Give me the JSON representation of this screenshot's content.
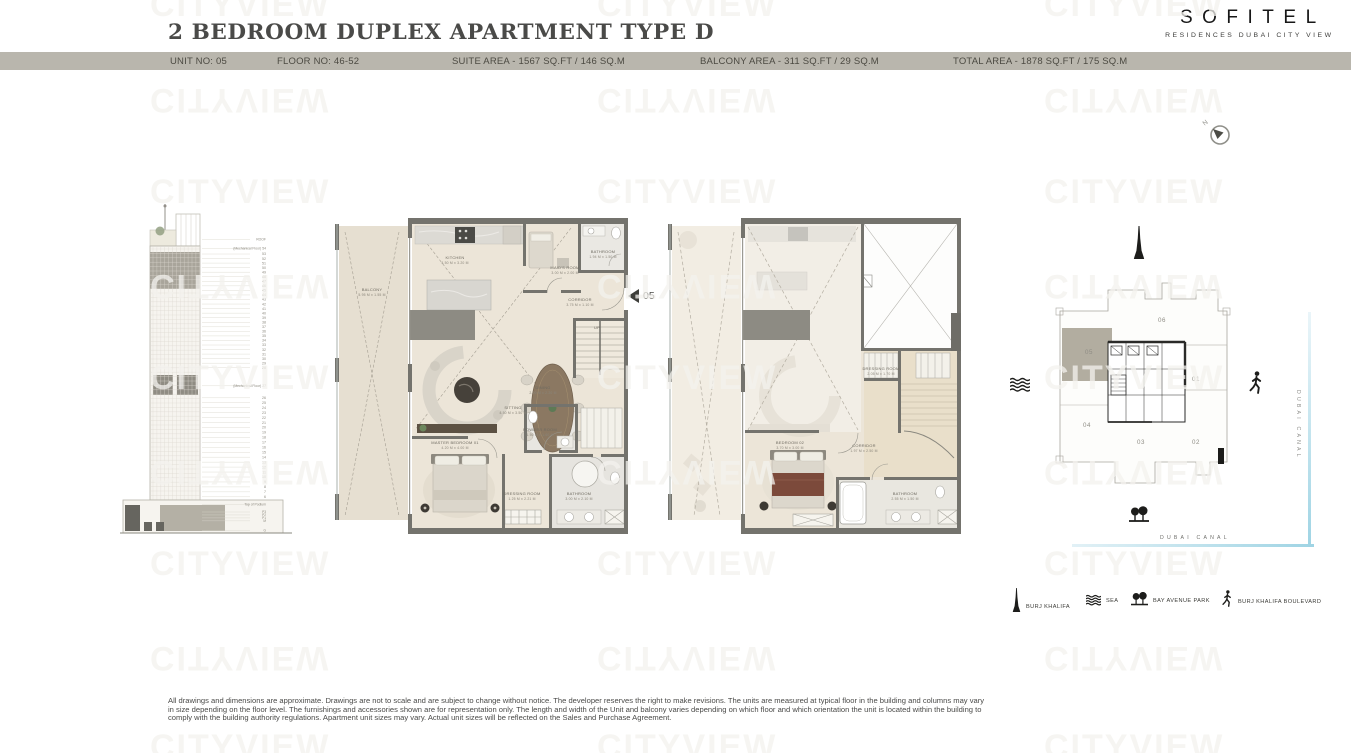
{
  "watermark": "CITYVIEW",
  "header": {
    "title": "2 BEDROOM DUPLEX APARTMENT TYPE D",
    "brand": {
      "name": "SOFITEL",
      "subtitle": "RESIDENCES DUBAI CITY VIEW"
    },
    "info_bar": {
      "unit": "UNIT NO: 05",
      "floor": "FLOOR NO: 46-52",
      "suite_area": "SUITE AREA - 1567 SQ.FT / 146 SQ.M",
      "balcony_area": "BALCONY AREA - 311 SQ.FT / 29 SQ.M",
      "total_area": "TOTAL AREA - 1878 SQ.FT / 175 SQ.M"
    }
  },
  "compass_label": "N",
  "unit_marker": "05",
  "elevation": {
    "top_label": "ROOF",
    "mech_upper": "(Mechanical Floor) 54",
    "upper_floors": [
      "53",
      "52",
      "51",
      "50",
      "49",
      "48",
      "47",
      "46",
      "45",
      "44",
      "43",
      "42",
      "41",
      "40",
      "39",
      "38",
      "37",
      "36",
      "35",
      "34",
      "33",
      "32",
      "31",
      "30",
      "29",
      "28"
    ],
    "mech_lower": "(Mechanical Floor) 27",
    "lower_floors": [
      "26",
      "25",
      "24",
      "23",
      "22",
      "21",
      "20",
      "19",
      "18",
      "17",
      "16",
      "15",
      "14",
      "13",
      "12",
      "11",
      "10",
      "9",
      "8",
      "7",
      "6"
    ],
    "podium_label": "Top of Podium",
    "podium_floors": [
      "P3",
      "P2",
      "P1",
      "M"
    ],
    "ground_label": "G"
  },
  "plans": {
    "lower": {
      "rooms": {
        "balcony": {
          "name": "BALCONY",
          "dims": "5.95 M x 1.55 M"
        },
        "kitchen": {
          "name": "KITCHEN",
          "dims": "4.50 M x 3.20 M"
        },
        "maids": {
          "name": "MAID'S ROOM",
          "dims": "3.00 M x 2.00 M"
        },
        "bath_top": {
          "name": "BATHROOM",
          "dims": "1.94 M x 1.50 M"
        },
        "corridor": {
          "name": "CORRIDOR",
          "dims": "3.75 M x 1.10 M"
        },
        "dining": {
          "name": "DINING",
          "dims": "2.00 M x 2.20 M"
        },
        "sitting": {
          "name": "SITTING",
          "dims": "4.50 M x 3.50 M"
        },
        "master": {
          "name": "MASTER BEDROOM 01",
          "dims": "4.20 M x 4.00 M"
        },
        "dressing": {
          "name": "DRESSING ROOM",
          "dims": "1.25 M x 2.21 M"
        },
        "bath_master": {
          "name": "BATHROOM",
          "dims": "3.00 M x 2.10 M"
        },
        "powder": {
          "name": "POWDER ROOM",
          "dims": "1.50 M x 1.60 M"
        },
        "stairs": {
          "name": "UP"
        }
      }
    },
    "upper": {
      "rooms": {
        "bedroom02": {
          "name": "BEDROOM 02",
          "dims": "3.70 M x 3.00 M"
        },
        "corridor": {
          "name": "CORRIDOR",
          "dims": "1.97 M x 2.50 M"
        },
        "bathroom": {
          "name": "BATHROOM",
          "dims": "2.55 M x 1.50 M"
        },
        "dressing": {
          "name": "DRESSING ROOM",
          "dims": "2.05 M x 1.70 M"
        }
      }
    }
  },
  "site_plan": {
    "units": [
      "06",
      "05",
      "01",
      "04",
      "03",
      "02"
    ],
    "highlighted_unit": "05",
    "canal_label_vertical": "DUBAI CANAL",
    "canal_label_horizontal": "DUBAI CANAL"
  },
  "legend": {
    "items": [
      {
        "icon": "burj-khalifa-icon",
        "label": "BURJ KHALIFA"
      },
      {
        "icon": "sea-icon",
        "label": "SEA"
      },
      {
        "icon": "park-icon",
        "label": "BAY AVENUE PARK"
      },
      {
        "icon": "pedestrian-icon",
        "label": "BURJ KHALIFA BOULEVARD"
      }
    ]
  },
  "disclaimer": [
    "All drawings and dimensions are approximate. Drawings are not to scale and are subject to change without notice. The developer reserves the right to make revisions. The units are measured at typical floor in the building and columns may vary",
    "in size depending on the floor level. The furnishings and accessories shown are for representation only. The length and width of the Unit and balcony varies depending on which floor and which orientation the unit is located within the building to",
    "comply with the building authority regulations. Apartment unit sizes may vary. Actual unit sizes will be reflected on the Sales and Purchase Agreement."
  ],
  "colors": {
    "info_bar_bg": "#b9b6ad",
    "plan_wall": "#74736d",
    "plan_floor": "#ece5d8",
    "highlight_unit": "#b2ada0",
    "canal_blue": "#9fd4e4",
    "bed_accent": "#7c4a3b"
  }
}
